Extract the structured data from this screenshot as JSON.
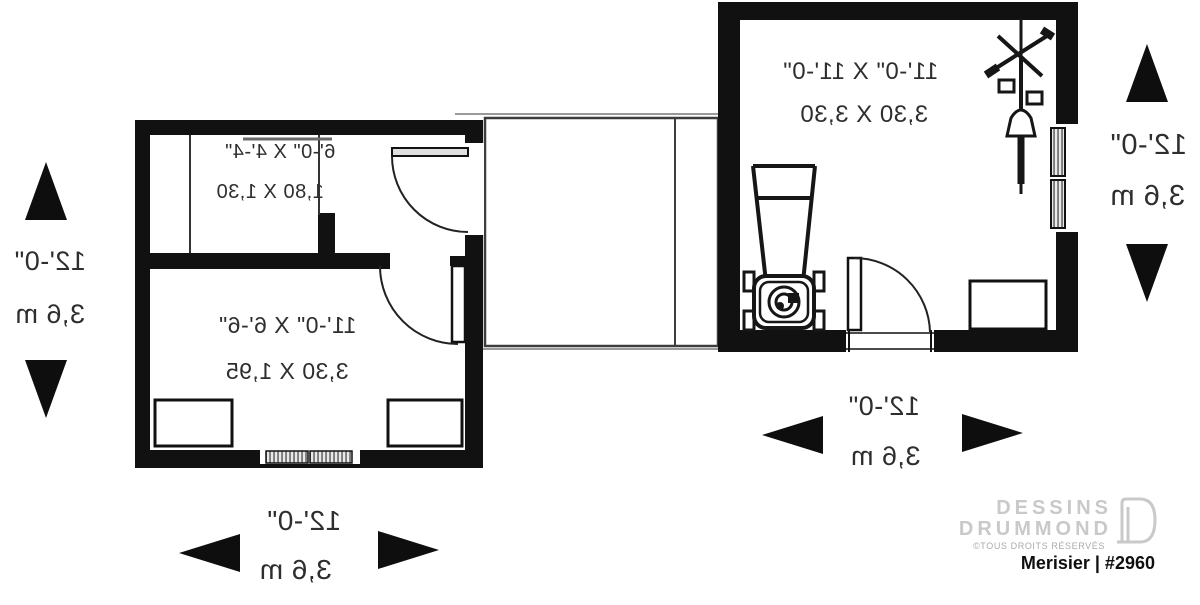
{
  "meta": {
    "drawing_type": "floor plan (mirrored print)"
  },
  "rooms": [
    {
      "name": "closet",
      "imperial": "6'-0\" X 4'-4\"",
      "metric": "1,80 X 1,30"
    },
    {
      "name": "storage",
      "imperial": "11'-0\" X 6'-6\"",
      "metric": "3,30 X 1,95"
    },
    {
      "name": "garage",
      "imperial": "11'-0\" X 11'-0\"",
      "metric": "3,30 X 3,30"
    }
  ],
  "dimensions": {
    "left": {
      "feet": "12'-0\"",
      "meters": "3,6 m"
    },
    "right": {
      "feet": "12'-0\"",
      "meters": "3,6 m"
    },
    "bottom_left": {
      "feet": "12'-0\"",
      "meters": "3,6 m"
    },
    "bottom_right": {
      "feet": "12'-0\"",
      "meters": "3,6 m"
    }
  },
  "branding": {
    "name_line1": "DESSINS",
    "name_line2": "DRUMMOND",
    "copyright": "©TOUS DROITS RÉSERVÉS",
    "plan_label": "Merisier | #2960"
  },
  "icons": {
    "mower": "lawnmower-icon",
    "bike": "bicycle-icon",
    "logo_door": "door-logo-icon"
  },
  "colors": {
    "wall": "#111111",
    "line": "#333333",
    "text": "#2e2e2e",
    "logo_gray": "#c9c9c9",
    "copyright_gray": "#ababab",
    "plan_text": "#0f0f0f"
  }
}
